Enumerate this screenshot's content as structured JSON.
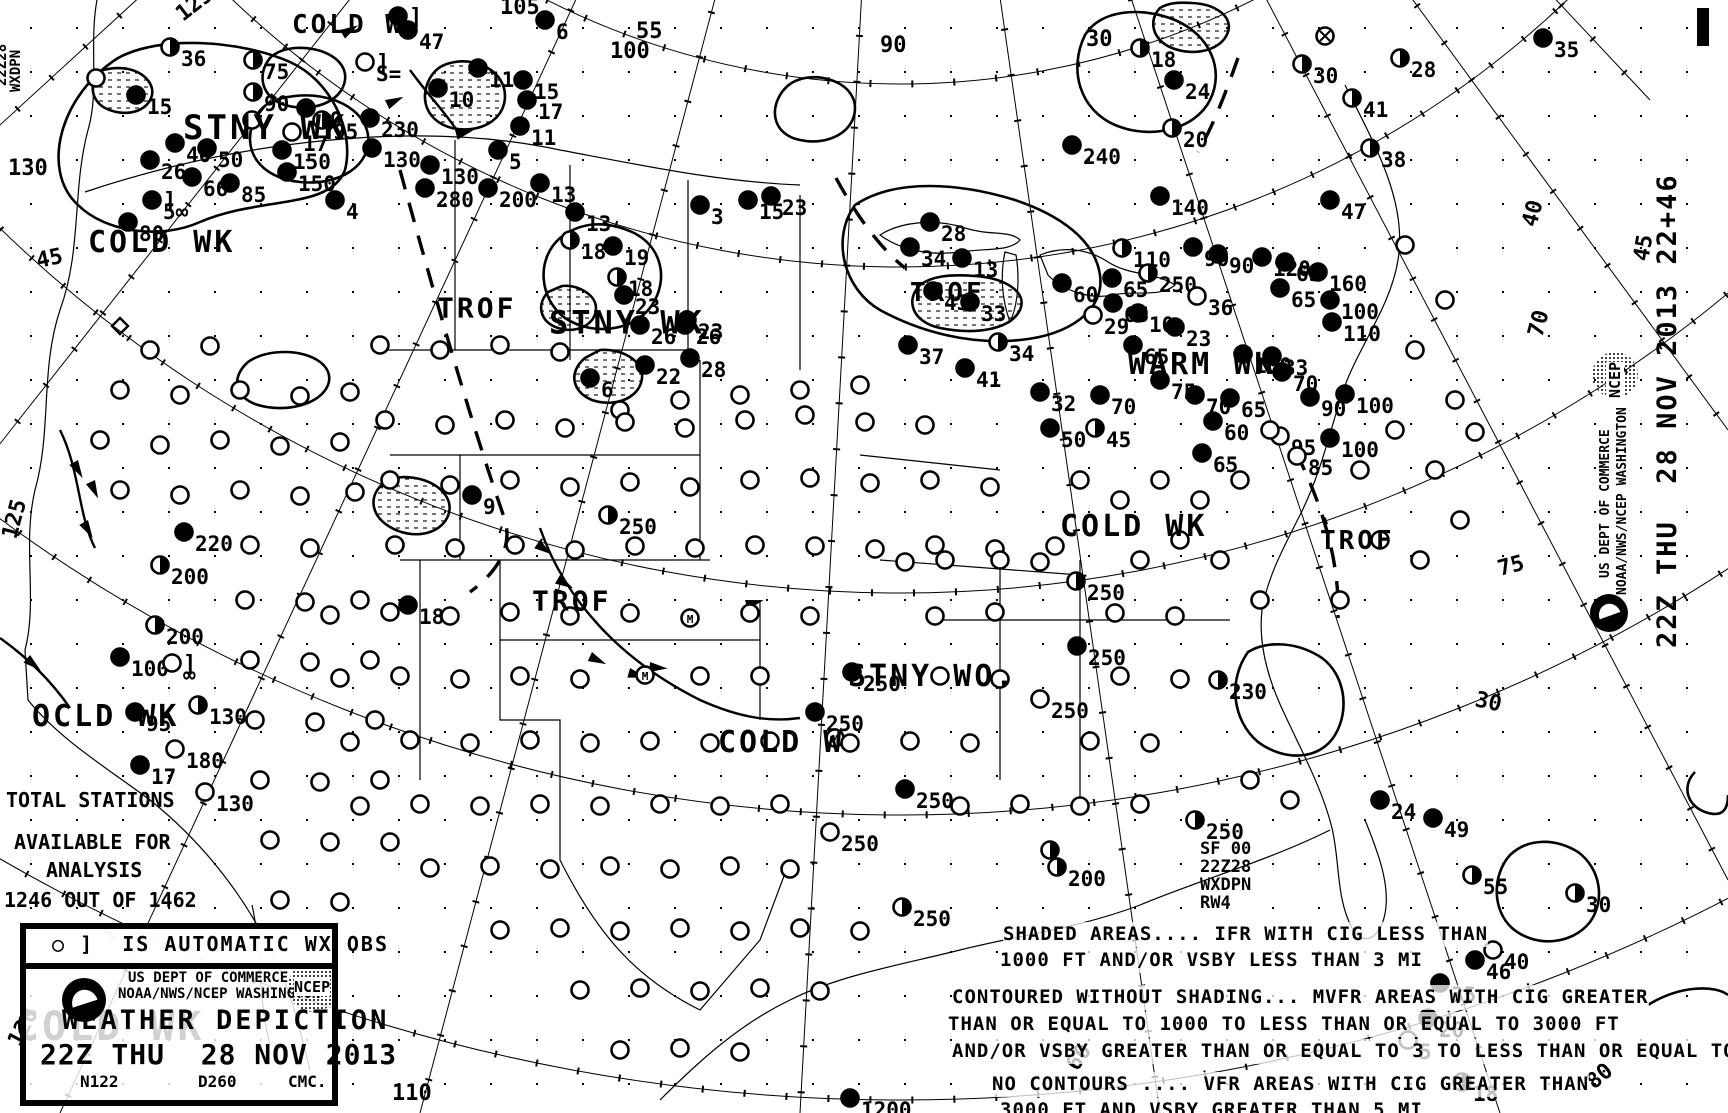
{
  "chart_title": "Weather Depiction Chart",
  "obs_box": {
    "label": "○ ]  IS AUTOMATIC WX OBS"
  },
  "stats": {
    "l1": "TOTAL STATIONS",
    "l2": "AVAILABLE FOR",
    "l3": "ANALYSIS",
    "l4": "1246 OUT OF 1462"
  },
  "agency": {
    "l1": "US DEPT OF COMMERCE",
    "l2": "NOAA/NWS/NCEP WASHINGTON",
    "ncep": "NCEP"
  },
  "title_block": {
    "l1": "WEATHER DEPICTION",
    "l2": "22Z THU  28 NOV 2013",
    "n1": "N122",
    "n2": "D260",
    "n3": "CMC."
  },
  "product_stamp": {
    "l1": "SF 00",
    "l2": "22Z28",
    "l3": "WXDPN",
    "l4": "RW4"
  },
  "left_stamp": {
    "l1": "22Z28",
    "l2": "WXDPN"
  },
  "side_stamp": {
    "datetime": "22Z THU  28 NOV 2013 22+46",
    "agency1": "US DEPT OF COMMERCE",
    "agency2": "NOAA/NWS/NCEP WASHINGTON",
    "ncep": "NCEP"
  },
  "legend": {
    "shaded1": "SHADED AREAS.... IFR WITH CIG LESS THAN",
    "shaded2": "1000 FT AND/OR VSBY LESS THAN 3 MI",
    "mvfr1": "CONTOURED WITHOUT SHADING... MVFR AREAS WITH CIG GREATER",
    "mvfr2": "THAN OR EQUAL TO 1000 TO LESS THAN OR EQUAL TO 3000 FT",
    "mvfr3": "AND/OR VSBY GREATER THAN OR EQUAL TO 3 TO LESS THAN OR EQUAL TO 5 MI",
    "vfr1": "NO CONTOURS .... VFR AREAS WITH CIG GREATER THAN",
    "vfr2": "3000 FT AND VSBY GREATER THAN 5 MI"
  },
  "region_labels": [
    {
      "t": "COLD W",
      "x": 292,
      "y": 12,
      "s": 26
    },
    {
      "t": "STNY WK",
      "x": 183,
      "y": 112,
      "s": 34
    },
    {
      "t": "COLD WK",
      "x": 88,
      "y": 228,
      "s": 30
    },
    {
      "t": "TROF",
      "x": 437,
      "y": 295,
      "s": 28
    },
    {
      "t": "STNY WK",
      "x": 549,
      "y": 308,
      "s": 32
    },
    {
      "t": "TROF",
      "x": 910,
      "y": 280,
      "s": 26
    },
    {
      "t": "WARM WK",
      "x": 1128,
      "y": 350,
      "s": 30
    },
    {
      "t": "COLD WK",
      "x": 1060,
      "y": 512,
      "s": 30
    },
    {
      "t": "TROF",
      "x": 1320,
      "y": 528,
      "s": 26
    },
    {
      "t": "TROF",
      "x": 532,
      "y": 588,
      "s": 28
    },
    {
      "t": "STNY WO.",
      "x": 848,
      "y": 662,
      "s": 30
    },
    {
      "t": "COLD W",
      "x": 718,
      "y": 728,
      "s": 30
    },
    {
      "t": "OCLD WK",
      "x": 32,
      "y": 702,
      "s": 30
    },
    {
      "t": "COLD WK",
      "x": 15,
      "y": 1008,
      "s": 40
    }
  ],
  "grid_labels": [
    {
      "t": "125",
      "x": 183,
      "y": 22,
      "r": -38
    },
    {
      "t": "130",
      "x": 8,
      "y": 175,
      "r": 0
    },
    {
      "t": "45",
      "x": 38,
      "y": 268,
      "r": -12
    },
    {
      "t": "125",
      "x": 16,
      "y": 540,
      "r": -75
    },
    {
      "t": "120",
      "x": 20,
      "y": 1048,
      "r": -62
    },
    {
      "t": "110",
      "x": 392,
      "y": 1100,
      "r": 0
    },
    {
      "t": "105",
      "x": 500,
      "y": 14,
      "r": 0
    },
    {
      "t": "55",
      "x": 636,
      "y": 38,
      "r": 0
    },
    {
      "t": "100",
      "x": 610,
      "y": 58,
      "r": 0
    },
    {
      "t": "90",
      "x": 880,
      "y": 52,
      "r": 0
    },
    {
      "t": "30",
      "x": 1086,
      "y": 46,
      "r": 0
    },
    {
      "t": "40",
      "x": 1536,
      "y": 228,
      "r": -75
    },
    {
      "t": "70",
      "x": 1542,
      "y": 338,
      "r": -75
    },
    {
      "t": "45",
      "x": 1648,
      "y": 262,
      "r": -80
    },
    {
      "t": "75",
      "x": 1500,
      "y": 576,
      "r": -15
    },
    {
      "t": "30",
      "x": 1474,
      "y": 706,
      "r": 12
    },
    {
      "t": "60",
      "x": 1077,
      "y": 1072,
      "r": -55
    },
    {
      "t": "80",
      "x": 1594,
      "y": 1090,
      "r": -40
    }
  ],
  "stations": [
    [
      170,
      47,
      "h",
      "36"
    ],
    [
      253,
      60,
      "h",
      "75"
    ],
    [
      253,
      92,
      "h",
      "90"
    ],
    [
      306,
      108,
      "f",
      "50"
    ],
    [
      136,
      95,
      "f",
      "15"
    ],
    [
      175,
      143,
      "f",
      "40"
    ],
    [
      207,
      148,
      "f",
      "50"
    ],
    [
      150,
      160,
      "f",
      "26"
    ],
    [
      282,
      150,
      "f",
      "150"
    ],
    [
      292,
      132,
      "o",
      "17"
    ],
    [
      322,
      120,
      "h",
      "95"
    ],
    [
      230,
      183,
      "f",
      "85"
    ],
    [
      192,
      177,
      "f",
      "66"
    ],
    [
      287,
      172,
      "f",
      "150"
    ],
    [
      335,
      200,
      "f",
      "4"
    ],
    [
      152,
      200,
      "af",
      "5∞"
    ],
    [
      128,
      222,
      "f",
      "80"
    ],
    [
      365,
      62,
      "a",
      "S="
    ],
    [
      398,
      16,
      "af",
      ""
    ],
    [
      545,
      20,
      "f",
      "6"
    ],
    [
      408,
      30,
      "f",
      "47"
    ],
    [
      438,
      88,
      "f",
      "10"
    ],
    [
      478,
      68,
      "f",
      "11"
    ],
    [
      523,
      80,
      "f",
      "15"
    ],
    [
      527,
      100,
      "f",
      "17"
    ],
    [
      520,
      126,
      "f",
      "11"
    ],
    [
      370,
      118,
      "f",
      "230"
    ],
    [
      372,
      148,
      "f",
      "130"
    ],
    [
      425,
      188,
      "f",
      "280"
    ],
    [
      488,
      188,
      "f",
      "200"
    ],
    [
      430,
      165,
      "f",
      "130"
    ],
    [
      540,
      183,
      "f",
      "13"
    ],
    [
      498,
      150,
      "f",
      "5"
    ],
    [
      575,
      212,
      "f",
      "13"
    ],
    [
      570,
      240,
      "h",
      "18"
    ],
    [
      613,
      246,
      "f",
      "19"
    ],
    [
      624,
      295,
      "f",
      "23"
    ],
    [
      687,
      320,
      "f",
      "23"
    ],
    [
      640,
      325,
      "f",
      "26"
    ],
    [
      685,
      325,
      "f",
      "26"
    ],
    [
      645,
      365,
      "f",
      "22"
    ],
    [
      690,
      358,
      "f",
      "28"
    ],
    [
      590,
      378,
      "f",
      "6"
    ],
    [
      617,
      277,
      "h",
      "18"
    ],
    [
      700,
      205,
      "f",
      "3"
    ],
    [
      748,
      200,
      "f",
      "15"
    ],
    [
      771,
      196,
      "f",
      "23"
    ],
    [
      930,
      222,
      "f",
      "28"
    ],
    [
      910,
      247,
      "f",
      "34"
    ],
    [
      962,
      258,
      "f",
      "13"
    ],
    [
      933,
      291,
      "f",
      "43"
    ],
    [
      970,
      302,
      "f",
      "33"
    ],
    [
      1122,
      248,
      "h",
      "110"
    ],
    [
      1148,
      273,
      "h",
      "250"
    ],
    [
      1193,
      247,
      "f",
      "90"
    ],
    [
      1072,
      145,
      "f",
      "240"
    ],
    [
      1160,
      196,
      "f",
      "140"
    ],
    [
      1062,
      283,
      "f",
      "60"
    ],
    [
      1112,
      278,
      "f",
      "65"
    ],
    [
      1113,
      303,
      "f",
      "65"
    ],
    [
      1093,
      315,
      "o",
      "29"
    ],
    [
      1138,
      313,
      "f",
      "10"
    ],
    [
      1175,
      327,
      "f",
      "23"
    ],
    [
      998,
      342,
      "h",
      "34"
    ],
    [
      908,
      345,
      "f",
      "37"
    ],
    [
      965,
      368,
      "f",
      "41"
    ],
    [
      1133,
      345,
      "f",
      "65"
    ],
    [
      1197,
      296,
      "o",
      "36"
    ],
    [
      1218,
      254,
      "f",
      "90"
    ],
    [
      1262,
      257,
      "f",
      "120"
    ],
    [
      1318,
      272,
      "f",
      "160"
    ],
    [
      1280,
      288,
      "f",
      "65"
    ],
    [
      1285,
      262,
      "f",
      "65"
    ],
    [
      1330,
      300,
      "f",
      "100"
    ],
    [
      1332,
      322,
      "f",
      "110"
    ],
    [
      1243,
      354,
      "f",
      "100"
    ],
    [
      1272,
      356,
      "f",
      "33"
    ],
    [
      1282,
      372,
      "f",
      "70"
    ],
    [
      1345,
      394,
      "f",
      "100"
    ],
    [
      1310,
      397,
      "f",
      "90"
    ],
    [
      1040,
      392,
      "f",
      "32"
    ],
    [
      1050,
      428,
      "f",
      "50"
    ],
    [
      1095,
      428,
      "h",
      "45"
    ],
    [
      1100,
      395,
      "f",
      "70"
    ],
    [
      1160,
      380,
      "f",
      "75"
    ],
    [
      1195,
      395,
      "f",
      "70"
    ],
    [
      1230,
      398,
      "f",
      "65"
    ],
    [
      1213,
      421,
      "f",
      "60"
    ],
    [
      1202,
      453,
      "f",
      "65"
    ],
    [
      1280,
      436,
      "o",
      "95"
    ],
    [
      1297,
      456,
      "o",
      "85"
    ],
    [
      1330,
      438,
      "f",
      "100"
    ],
    [
      1370,
      148,
      "h",
      "38"
    ],
    [
      1330,
      200,
      "f",
      "47"
    ],
    [
      1352,
      98,
      "h",
      "41"
    ],
    [
      1400,
      58,
      "h",
      "28"
    ],
    [
      1302,
      64,
      "h",
      "30"
    ],
    [
      1140,
      48,
      "h",
      "18"
    ],
    [
      1174,
      80,
      "f",
      "24"
    ],
    [
      1172,
      128,
      "h",
      "20"
    ],
    [
      1543,
      38,
      "f",
      "35"
    ],
    [
      1325,
      36,
      "x",
      ""
    ],
    [
      184,
      532,
      "f",
      "220"
    ],
    [
      160,
      565,
      "h",
      "200"
    ],
    [
      120,
      657,
      "f",
      "100"
    ],
    [
      172,
      663,
      "a",
      "∞"
    ],
    [
      155,
      625,
      "h",
      "200"
    ],
    [
      198,
      705,
      "h",
      "130"
    ],
    [
      135,
      712,
      "f",
      "95"
    ],
    [
      175,
      749,
      "o",
      "180"
    ],
    [
      140,
      765,
      "f",
      "17"
    ],
    [
      205,
      792,
      "o",
      "130"
    ],
    [
      472,
      495,
      "f",
      "9"
    ],
    [
      608,
      515,
      "h",
      "250"
    ],
    [
      408,
      605,
      "f",
      "18"
    ],
    [
      852,
      672,
      "f",
      "250"
    ],
    [
      815,
      712,
      "f",
      "250"
    ],
    [
      1076,
      581,
      "h",
      "250"
    ],
    [
      1077,
      646,
      "f",
      "250"
    ],
    [
      1040,
      699,
      "o",
      "250"
    ],
    [
      905,
      789,
      "f",
      "250"
    ],
    [
      830,
      832,
      "o",
      "250"
    ],
    [
      902,
      907,
      "h",
      "250"
    ],
    [
      1057,
      867,
      "h",
      "200"
    ],
    [
      1050,
      850,
      "h",
      ""
    ],
    [
      850,
      1098,
      "f",
      "1200"
    ],
    [
      1218,
      680,
      "h",
      "230"
    ],
    [
      1195,
      820,
      "h",
      "250"
    ],
    [
      1380,
      800,
      "f",
      "24"
    ],
    [
      1433,
      818,
      "f",
      "49"
    ],
    [
      1472,
      875,
      "h",
      "55"
    ],
    [
      1575,
      893,
      "h",
      "30"
    ],
    [
      1475,
      960,
      "f",
      "46"
    ],
    [
      1440,
      983,
      "f",
      "35"
    ],
    [
      1428,
      1018,
      "f",
      "20"
    ],
    [
      1462,
      1082,
      "h",
      "18"
    ],
    [
      1493,
      950,
      "o",
      "40"
    ],
    [
      1408,
      1040,
      "o",
      "5"
    ],
    [
      120,
      326,
      "d",
      ""
    ],
    [
      690,
      618,
      "m",
      ""
    ],
    [
      835,
      738,
      "m",
      ""
    ],
    [
      645,
      675,
      "m",
      ""
    ]
  ],
  "field_circles": [
    [
      380,
      345
    ],
    [
      440,
      350
    ],
    [
      500,
      345
    ],
    [
      560,
      352
    ],
    [
      620,
      410
    ],
    [
      680,
      400
    ],
    [
      740,
      395
    ],
    [
      800,
      390
    ],
    [
      860,
      385
    ],
    [
      385,
      420
    ],
    [
      445,
      425
    ],
    [
      505,
      420
    ],
    [
      565,
      428
    ],
    [
      625,
      422
    ],
    [
      685,
      428
    ],
    [
      745,
      420
    ],
    [
      805,
      415
    ],
    [
      865,
      422
    ],
    [
      925,
      425
    ],
    [
      390,
      480
    ],
    [
      450,
      485
    ],
    [
      510,
      480
    ],
    [
      570,
      487
    ],
    [
      630,
      482
    ],
    [
      690,
      487
    ],
    [
      750,
      480
    ],
    [
      810,
      478
    ],
    [
      870,
      483
    ],
    [
      930,
      480
    ],
    [
      990,
      487
    ],
    [
      395,
      545
    ],
    [
      455,
      548
    ],
    [
      515,
      545
    ],
    [
      575,
      550
    ],
    [
      635,
      546
    ],
    [
      695,
      548
    ],
    [
      755,
      545
    ],
    [
      815,
      546
    ],
    [
      875,
      549
    ],
    [
      935,
      545
    ],
    [
      995,
      549
    ],
    [
      1055,
      546
    ],
    [
      330,
      615
    ],
    [
      390,
      612
    ],
    [
      450,
      616
    ],
    [
      510,
      612
    ],
    [
      570,
      616
    ],
    [
      630,
      613
    ],
    [
      750,
      613
    ],
    [
      810,
      616
    ],
    [
      935,
      616
    ],
    [
      995,
      612
    ],
    [
      1115,
      613
    ],
    [
      1175,
      616
    ],
    [
      340,
      678
    ],
    [
      400,
      676
    ],
    [
      460,
      679
    ],
    [
      520,
      676
    ],
    [
      580,
      679
    ],
    [
      700,
      676
    ],
    [
      760,
      676
    ],
    [
      940,
      676
    ],
    [
      1000,
      679
    ],
    [
      1120,
      676
    ],
    [
      1180,
      679
    ],
    [
      350,
      742
    ],
    [
      410,
      740
    ],
    [
      470,
      743
    ],
    [
      530,
      740
    ],
    [
      590,
      743
    ],
    [
      650,
      741
    ],
    [
      710,
      743
    ],
    [
      770,
      741
    ],
    [
      850,
      743
    ],
    [
      910,
      741
    ],
    [
      970,
      743
    ],
    [
      1090,
      741
    ],
    [
      1150,
      743
    ],
    [
      360,
      806
    ],
    [
      420,
      804
    ],
    [
      480,
      806
    ],
    [
      540,
      804
    ],
    [
      600,
      806
    ],
    [
      660,
      804
    ],
    [
      720,
      806
    ],
    [
      780,
      804
    ],
    [
      960,
      806
    ],
    [
      1020,
      804
    ],
    [
      1080,
      806
    ],
    [
      1140,
      804
    ],
    [
      430,
      868
    ],
    [
      490,
      866
    ],
    [
      550,
      869
    ],
    [
      610,
      866
    ],
    [
      670,
      869
    ],
    [
      730,
      866
    ],
    [
      790,
      869
    ],
    [
      500,
      930
    ],
    [
      560,
      928
    ],
    [
      620,
      931
    ],
    [
      680,
      928
    ],
    [
      740,
      931
    ],
    [
      800,
      928
    ],
    [
      860,
      931
    ],
    [
      580,
      990
    ],
    [
      640,
      988
    ],
    [
      700,
      991
    ],
    [
      760,
      988
    ],
    [
      820,
      991
    ],
    [
      620,
      1050
    ],
    [
      680,
      1048
    ],
    [
      740,
      1052
    ],
    [
      150,
      350
    ],
    [
      210,
      346
    ],
    [
      120,
      390
    ],
    [
      180,
      395
    ],
    [
      240,
      390
    ],
    [
      300,
      396
    ],
    [
      350,
      392
    ],
    [
      100,
      440
    ],
    [
      160,
      445
    ],
    [
      220,
      440
    ],
    [
      280,
      446
    ],
    [
      340,
      442
    ],
    [
      120,
      490
    ],
    [
      180,
      495
    ],
    [
      240,
      490
    ],
    [
      300,
      496
    ],
    [
      355,
      492
    ],
    [
      250,
      545
    ],
    [
      310,
      548
    ],
    [
      245,
      600
    ],
    [
      305,
      602
    ],
    [
      360,
      600
    ],
    [
      250,
      660
    ],
    [
      310,
      662
    ],
    [
      370,
      660
    ],
    [
      255,
      720
    ],
    [
      315,
      722
    ],
    [
      375,
      720
    ],
    [
      260,
      780
    ],
    [
      320,
      782
    ],
    [
      380,
      780
    ],
    [
      270,
      840
    ],
    [
      330,
      842
    ],
    [
      390,
      842
    ],
    [
      280,
      900
    ],
    [
      340,
      902
    ],
    [
      1405,
      245
    ],
    [
      1445,
      300
    ],
    [
      1415,
      350
    ],
    [
      1455,
      400
    ],
    [
      1395,
      430
    ],
    [
      1435,
      470
    ],
    [
      1475,
      432
    ],
    [
      1360,
      470
    ],
    [
      1380,
      540
    ],
    [
      1420,
      560
    ],
    [
      1460,
      520
    ],
    [
      1340,
      600
    ],
    [
      1260,
      600
    ],
    [
      1220,
      560
    ],
    [
      1180,
      540
    ],
    [
      1140,
      560
    ],
    [
      1240,
      480
    ],
    [
      1200,
      500
    ],
    [
      1160,
      480
    ],
    [
      1120,
      500
    ],
    [
      1080,
      480
    ],
    [
      1270,
      430
    ],
    [
      1000,
      560
    ],
    [
      1040,
      562
    ],
    [
      945,
      560
    ],
    [
      905,
      562
    ],
    [
      1250,
      780
    ],
    [
      1290,
      800
    ],
    [
      96,
      78
    ],
    [
      252,
      120
    ]
  ],
  "front_pips": [
    [
      385,
      100,
      -25
    ],
    [
      430,
      85,
      -20
    ],
    [
      540,
      540,
      35
    ],
    [
      592,
      652,
      25
    ],
    [
      650,
      662,
      5
    ],
    [
      745,
      600,
      -15
    ],
    [
      95,
      480,
      65
    ],
    [
      30,
      655,
      40
    ],
    [
      110,
      925,
      55
    ],
    [
      78,
      460,
      60
    ],
    [
      88,
      520,
      60
    ],
    [
      560,
      575,
      30
    ],
    [
      630,
      668,
      15
    ],
    [
      340,
      30,
      -30
    ],
    [
      455,
      130,
      -15
    ]
  ]
}
